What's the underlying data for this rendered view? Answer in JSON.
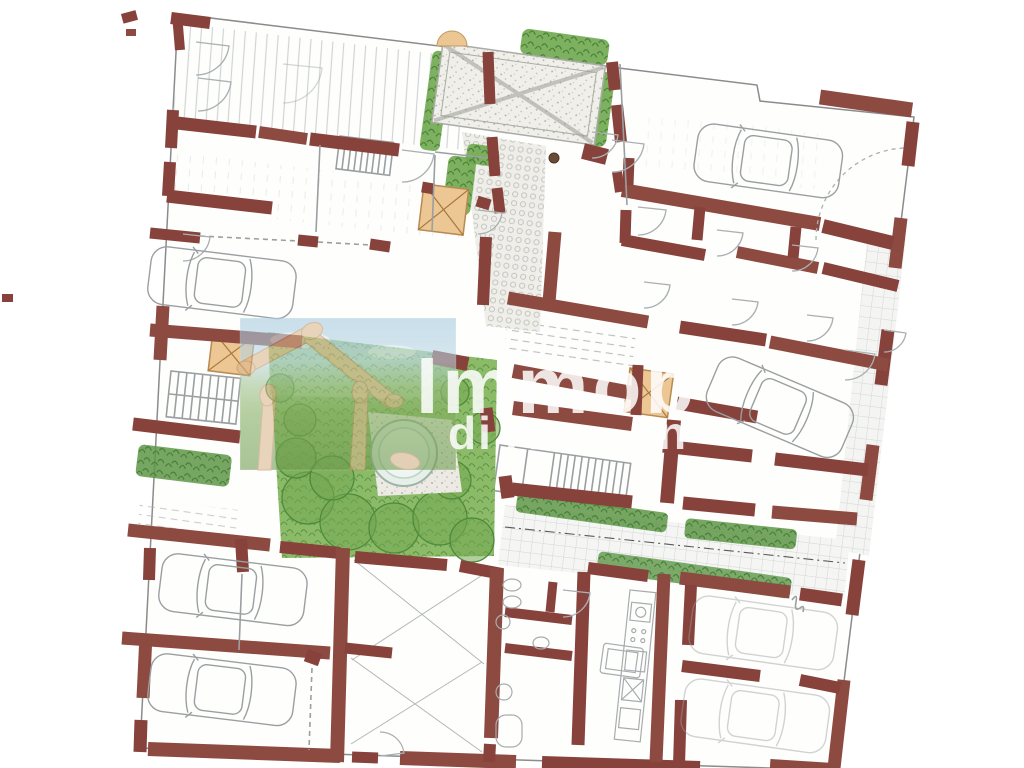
{
  "watermark": {
    "line1": "Immob",
    "line2": "di A",
    "fragment": "n",
    "color": "#ffffff"
  },
  "palette": {
    "wall_red": "#87423c",
    "paper": "#ffffff",
    "vegetation": "#6fa84f",
    "hedge": "#5e9747",
    "skylight_tan": "#ecc693",
    "pencil_gray": "#9b9fa2",
    "fountain_water": "#e7efe9",
    "mural_sky": "#a3c9de",
    "mural_grass": "#7aa455"
  },
  "plan_features": {
    "cars_visible": 7,
    "staircases": 3,
    "skylight_squares": 3,
    "fountains": 1,
    "pergolas": 1
  }
}
